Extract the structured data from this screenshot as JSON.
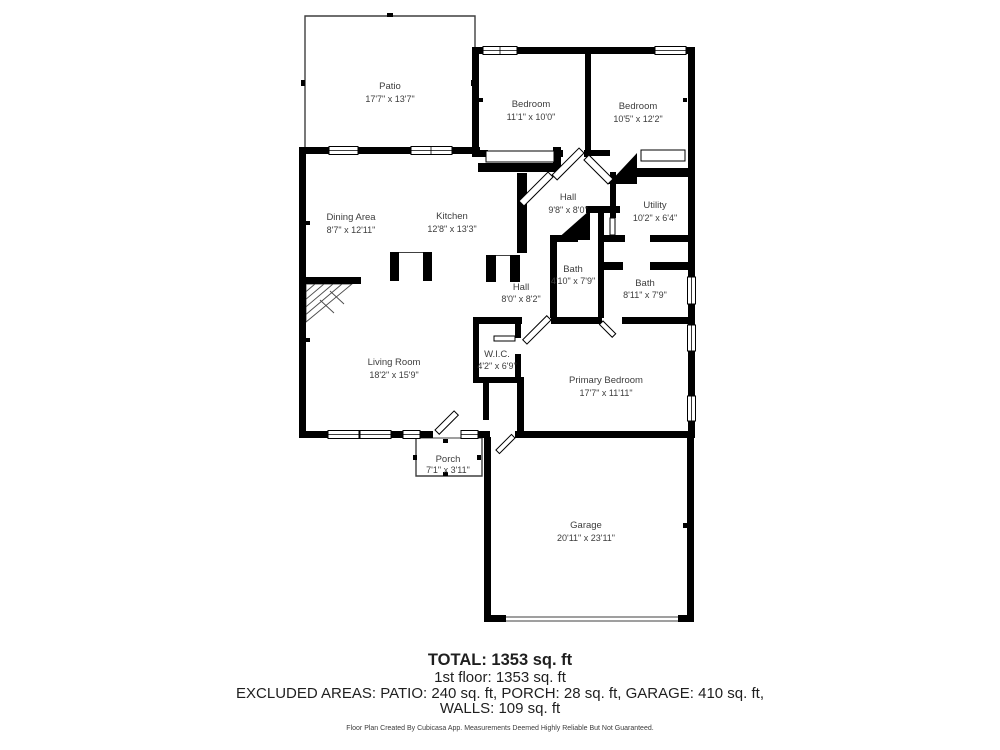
{
  "plan": {
    "rooms": [
      {
        "name": "Patio",
        "dims": "17'7\" x 13'7\""
      },
      {
        "name": "Bedroom",
        "dims": "11'1\" x 10'0\""
      },
      {
        "name": "Bedroom",
        "dims": "10'5\" x 12'2\""
      },
      {
        "name": "Dining Area",
        "dims": "8'7\" x 12'11\""
      },
      {
        "name": "Kitchen",
        "dims": "12'8\" x 13'3\""
      },
      {
        "name": "Hall",
        "dims": "9'8\" x 8'0\""
      },
      {
        "name": "Utility",
        "dims": "10'2\" x 6'4\""
      },
      {
        "name": "Bath",
        "dims": "4'10\" x 7'9\""
      },
      {
        "name": "Bath",
        "dims": "8'11\" x 7'9\""
      },
      {
        "name": "Hall",
        "dims": "8'0\" x 8'2\""
      },
      {
        "name": "Living Room",
        "dims": "18'2\" x 15'9\""
      },
      {
        "name": "W.I.C.",
        "dims": "4'2\" x 6'9\""
      },
      {
        "name": "Primary Bedroom",
        "dims": "17'7\" x 11'11\""
      },
      {
        "name": "Porch",
        "dims": "7'1\" x 3'11\""
      },
      {
        "name": "Garage",
        "dims": "20'11\" x 23'11\""
      }
    ]
  },
  "summary": {
    "total": "TOTAL: 1353 sq. ft",
    "first_floor": "1st floor: 1353 sq. ft",
    "excluded_areas": "EXCLUDED AREAS: PATIO: 240 sq. ft, PORCH: 28 sq. ft, GARAGE: 410 sq. ft,",
    "walls": "WALLS: 109 sq. ft"
  },
  "credit": "Floor Plan Created By Cubicasa App. Measurements Deemed Highly Reliable But Not Guaranteed.",
  "colors": {
    "wall": "#000000",
    "background": "#ffffff",
    "label_text": "#3d3d3d",
    "summary_text": "#1f1f1f"
  }
}
